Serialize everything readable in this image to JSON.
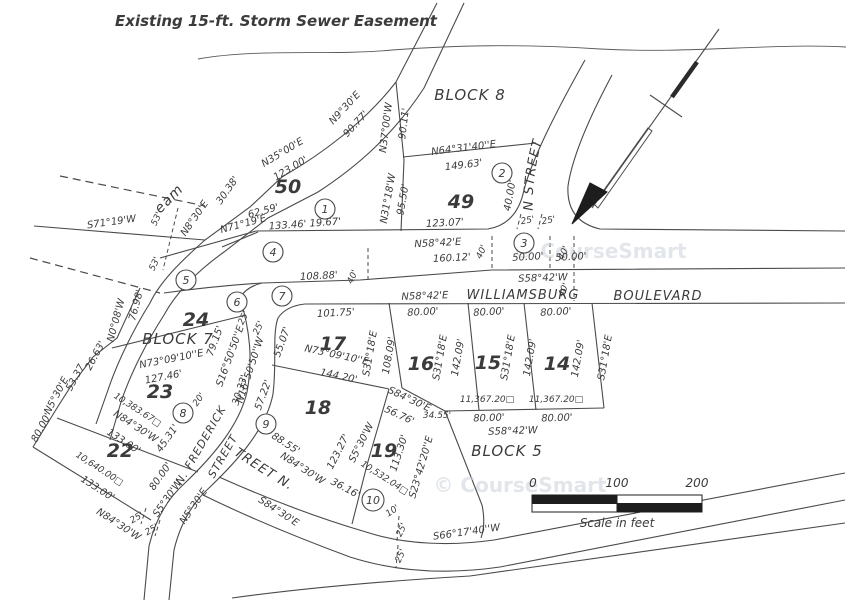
{
  "labels": {
    "easement_title": "Existing 15-ft. Storm Sewer Easement",
    "block8": "BLOCK 8",
    "block7": "BLOCK 7",
    "block5": "BLOCK 5",
    "lot50": "50",
    "lot49": "49",
    "lot24": "24",
    "lot23": "23",
    "lot22": "22",
    "lot17": "17",
    "lot16": "16",
    "lot15": "15",
    "lot14": "14",
    "lot18": "18",
    "lot19": "19",
    "stream": "Stream",
    "emerson": "N. EMERSON STREET",
    "frederick": "N. FREDERICK",
    "frederick_street": "STREET",
    "third_street": "33RD STREET N.",
    "williamsburg": "WILLIAMSBURG",
    "boulevard": "BOULEVARD",
    "n35": "N35°00'E",
    "d123_00": "123.00'",
    "n9_30": "N9°30'E",
    "d90_77": "90.77'",
    "n37": "N37°00'W",
    "d90_11": "90.11'",
    "n64": "N64°31'40''E",
    "d149_63": "149.63'",
    "n31": "N31°18'W",
    "d95_50": "95.50'",
    "d133_46": "133.46'  19.67'",
    "d123_07": "123.07'",
    "n58a": "N58°42'E",
    "d160_12": "160.12'",
    "d50a": "50.00'",
    "d50b": "50.00'",
    "s58a": "S58°42'W",
    "n58b": "N58°42'E",
    "d108_88": "108.88'",
    "d40a": "40'",
    "d40b": "40'",
    "d40c": "40'",
    "d40d": "40'",
    "d40_00": "40.00'",
    "d25a": "25'",
    "d25b": "25'",
    "n71": "N71°19'E",
    "d62_59": "62.59'",
    "s71": "S71°19'W",
    "n8_30": "N8°30'E",
    "d30_38": "30.38'",
    "d53a": "53'",
    "d53b": "53'",
    "d101_75": "101.75'",
    "d80a": "80.00'",
    "d80b": "80.00'",
    "d80c": "80.00'",
    "s31a": "S31°18'E",
    "d108_09": "108.09'",
    "s31b": "S31°18'E",
    "d142a": "142.09'",
    "s31c": "S31°18'E",
    "d142b": "142.09'",
    "d142c": "142.09'",
    "s31d": "S31°18'E",
    "area15": "11,367.20□",
    "area14": "11,367.20□",
    "d80d": "80.00'",
    "d80e": "80.00'",
    "s58b": "S58°42'W",
    "n73a": "N73°09'10''E",
    "d127_46": "127.46'",
    "n73b": "N73°09'10''E",
    "d144_20": "144.20'",
    "d79_15": "79.15'",
    "d55_07": "55.07'",
    "d57_22": "57.22'",
    "s16": "S16°50'50''E",
    "n16": "N16°50'50''W",
    "d30_33": "30.33'",
    "d25c": "25'",
    "d25d": "25'",
    "d20": "20'",
    "s5a": "S5°30'W",
    "n5a": "N5°30'E",
    "d25e": "25'",
    "d25f": "25'",
    "d80w": "80.00'",
    "n5w": "N5°30'E",
    "d53_37": "53.37",
    "d26_63": "26.63'",
    "n0": "N0°08'W",
    "d76_98": "76.98'",
    "area23": "10,383.67□",
    "n84a": "N84°30'W",
    "d133a": "133.00'",
    "d45_31": "45.31'",
    "area22": "10,640.00□",
    "d133b": "133.00'",
    "n84b": "N84°30'W",
    "d80f": "80.00'",
    "s84a": "S84°30'E",
    "d88_55": "88.55'",
    "n84c": "N84°30'W",
    "d36_16": "36.16'",
    "d123_27": "123.27'",
    "s5b": "S5°30'W",
    "s84b": "S84°30'E",
    "d56_76": "56.76'",
    "d34_55": "34.55'",
    "d113_30": "113.30'",
    "s23": "S23°42'20''E",
    "area19": "10,532.04□",
    "d10": "10'",
    "s66": "S66°17'40''W",
    "d25g": "25'",
    "d25h": "25'",
    "watermark": "© CourseSmart"
  },
  "curves": {
    "c1": "1",
    "c2": "2",
    "c3": "3",
    "c4": "4",
    "c5": "5",
    "c6": "6",
    "c7": "7",
    "c8": "8",
    "c9": "9",
    "c10": "10"
  },
  "scale": {
    "t0": "0",
    "t100": "100",
    "t200": "200",
    "label": "Scale in feet"
  }
}
